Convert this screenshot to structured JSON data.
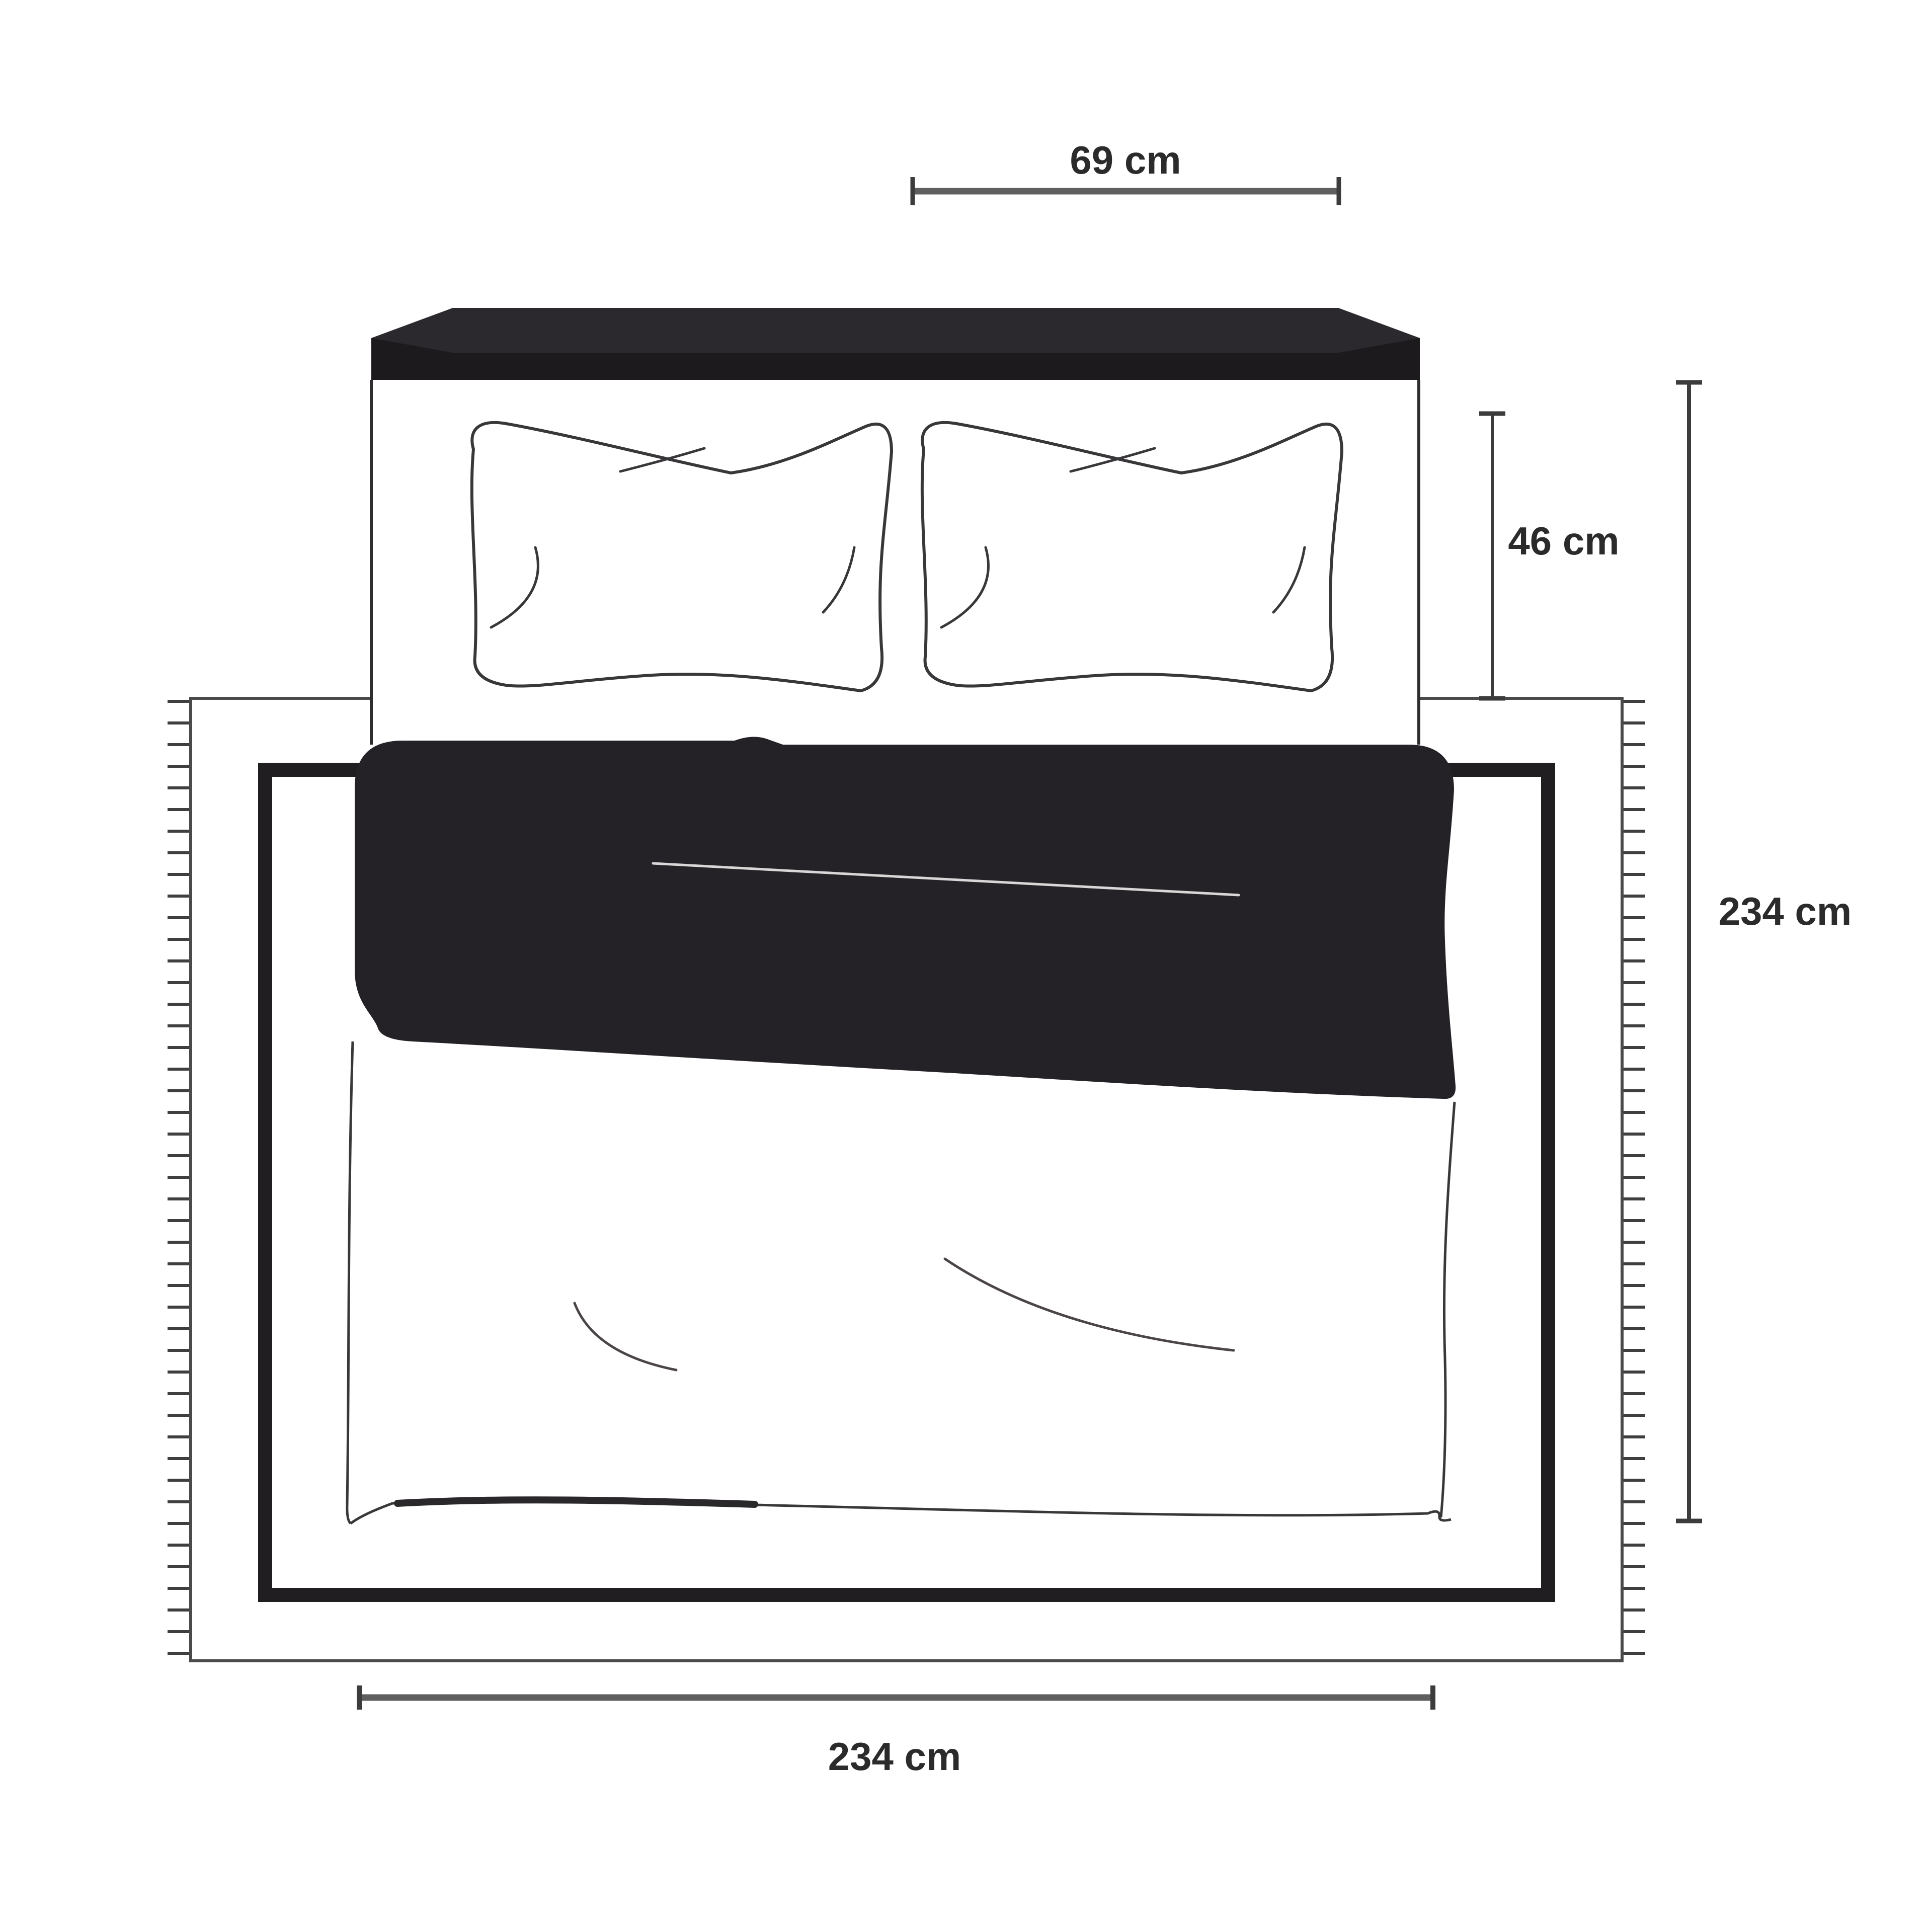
{
  "page": {
    "title": "Bed and rug dimensions diagram"
  },
  "dimensions": {
    "pillow_width_label": "69 cm",
    "pillow_height_label": "46 cm",
    "bed_length_label": "234 cm",
    "bed_width_label": "234 cm"
  },
  "colors": {
    "background": "#ffffff",
    "headboard_top": "#2b292d",
    "headboard_front": "#1c1a1d",
    "duvet_fill": "#242226",
    "duvet_edge": "#1b191c",
    "duvet_crease": "#d8d8d8",
    "outline": "#39373a",
    "bed_side": "#2f2d30",
    "sheet_accent": "#2a282b",
    "sheet_crease": "#4b4547",
    "rug_edge": "#4a4a4a",
    "rug_fringe": "#3f3f3f",
    "rug_border": "#201e21",
    "dim_line": "#5f5f5f",
    "dim_tick": "#3c3c3c",
    "dim_text": "#2b2b2b"
  }
}
